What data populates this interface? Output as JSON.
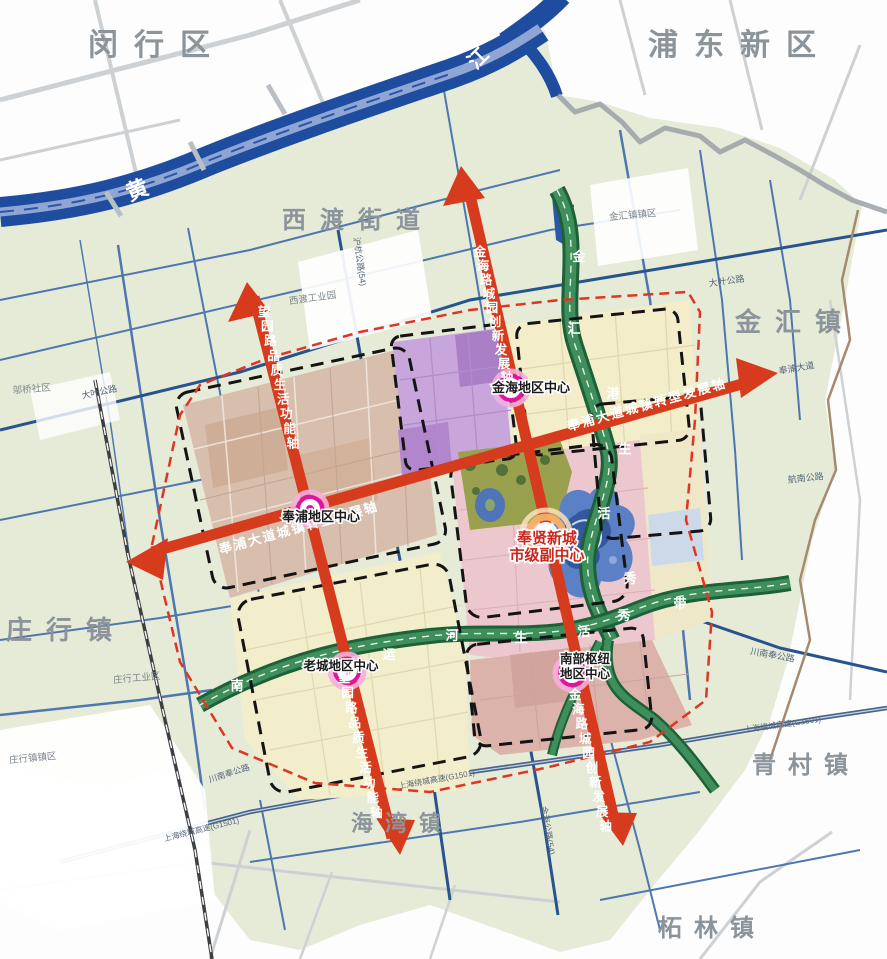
{
  "map_type": "urban-planning-structure-map",
  "core_label": "奉贤新城市级副中心",
  "labels": {
    "districts": [
      {
        "t": "闵行区",
        "x": 157,
        "y": 55,
        "s": 30,
        "ls": 16
      },
      {
        "t": "浦东新区",
        "x": 740,
        "y": 55,
        "s": 30,
        "ls": 16
      },
      {
        "t": "金汇镇",
        "x": 795,
        "y": 331,
        "s": 26,
        "ls": 14
      },
      {
        "t": "庄行镇",
        "x": 66,
        "y": 639,
        "s": 26,
        "ls": 14
      },
      {
        "t": "青村镇",
        "x": 806,
        "y": 773,
        "s": 24,
        "ls": 12
      },
      {
        "t": "柘林镇",
        "x": 712,
        "y": 936,
        "s": 24,
        "ls": 12
      },
      {
        "t": "海湾镇",
        "x": 402,
        "y": 831,
        "s": 22,
        "ls": 12
      },
      {
        "t": "西渡街道",
        "x": 358,
        "y": 228,
        "s": 24,
        "ls": 14
      }
    ],
    "settlements": [
      {
        "t": "西渡工业园",
        "x": 313,
        "y": 301,
        "s": 9.5,
        "rot": -8
      },
      {
        "t": "庄行工业区",
        "x": 137,
        "y": 681,
        "s": 9.5,
        "rot": -5
      },
      {
        "t": "庄行镇镇区",
        "x": 33,
        "y": 761,
        "s": 9.5,
        "rot": -5
      },
      {
        "t": "金汇镇镇区",
        "x": 633,
        "y": 218,
        "s": 9.5,
        "rot": -5
      },
      {
        "t": "邬桥社区",
        "x": 32,
        "y": 392,
        "s": 9.5,
        "rot": -5
      }
    ],
    "roads": [
      {
        "t": "大叶公路",
        "x": 100,
        "y": 395,
        "s": 9,
        "rot": -12
      },
      {
        "t": "大叶公路",
        "x": 727,
        "y": 284,
        "s": 9,
        "rot": -8
      },
      {
        "t": "沪杭公路(54)",
        "x": 357,
        "y": 262,
        "s": 8.5,
        "rot": 82
      },
      {
        "t": "奉浦大道",
        "x": 797,
        "y": 371,
        "s": 9,
        "rot": -10
      },
      {
        "t": "航南公路",
        "x": 806,
        "y": 481,
        "s": 9,
        "rot": -6
      },
      {
        "t": "川南奉公路",
        "x": 772,
        "y": 658,
        "s": 9,
        "rot": 10
      },
      {
        "t": "上海绕城高速(G1501)",
        "x": 783,
        "y": 727,
        "s": 8,
        "rot": -8
      },
      {
        "t": "上海绕城高速(G1501)",
        "x": 437,
        "y": 782,
        "s": 8,
        "rot": -10
      },
      {
        "t": "上海绕城高速(G1501)",
        "x": 202,
        "y": 832,
        "s": 8,
        "rot": -14
      },
      {
        "t": "金海公路(54)",
        "x": 545,
        "y": 831,
        "s": 8.5,
        "rot": 80
      },
      {
        "t": "川南奉公路",
        "x": 230,
        "y": 776,
        "s": 8.5,
        "rot": -18
      }
    ],
    "river_chars": [
      {
        "t": "黄",
        "x": 140,
        "y": 197,
        "s": 22,
        "rot": -22
      },
      {
        "t": "浦",
        "x": 306,
        "y": 102,
        "s": 22,
        "rot": -15
      },
      {
        "t": "江",
        "x": 483,
        "y": 63,
        "s": 20,
        "rot": -45
      }
    ],
    "corridor_chars": [
      {
        "t": "金",
        "x": 579,
        "y": 261,
        "s": 13
      },
      {
        "t": "汇",
        "x": 574,
        "y": 333,
        "s": 13
      },
      {
        "t": "港",
        "x": 613,
        "y": 398,
        "s": 13
      },
      {
        "t": "生",
        "x": 625,
        "y": 453,
        "s": 13
      },
      {
        "t": "活",
        "x": 604,
        "y": 518,
        "s": 13
      },
      {
        "t": "秀",
        "x": 630,
        "y": 583,
        "s": 13
      },
      {
        "t": "南",
        "x": 237,
        "y": 690,
        "s": 13
      },
      {
        "t": "运",
        "x": 389,
        "y": 659,
        "s": 13
      },
      {
        "t": "河",
        "x": 452,
        "y": 640,
        "s": 13
      },
      {
        "t": "生",
        "x": 521,
        "y": 642,
        "s": 13
      },
      {
        "t": "活",
        "x": 584,
        "y": 636,
        "s": 13
      },
      {
        "t": "秀",
        "x": 624,
        "y": 620,
        "s": 13
      },
      {
        "t": "带",
        "x": 680,
        "y": 608,
        "s": 13
      }
    ],
    "axis_labels": [
      {
        "t": "奉浦大道城镇转型发展轴",
        "x": 300,
        "y": 532,
        "s": 13,
        "rot": -15.5,
        "ls": 2
      },
      {
        "t": "奉浦大道城镇转型发展轴",
        "x": 648,
        "y": 409,
        "s": 13,
        "rot": -15.5,
        "ls": 2
      },
      {
        "t": "望园路品质生活功能轴",
        "x": 264,
        "y": 316,
        "s": 12.5,
        "dx": 3.2,
        "dy": 14.6
      },
      {
        "t": "望园路品质生活功能轴",
        "x": 344,
        "y": 682,
        "s": 12.5,
        "dx": 3.6,
        "dy": 15
      },
      {
        "t": "金海路城园创新发展轴",
        "x": 480,
        "y": 256,
        "s": 12.5,
        "dx": 3.0,
        "dy": 14
      },
      {
        "t": "金海路城园创新发展轴",
        "x": 575,
        "y": 699,
        "s": 12.5,
        "dx": 3.4,
        "dy": 14.6
      }
    ]
  },
  "centers": [
    {
      "type": "main",
      "lines": [
        "奉贤新城",
        "市级副中心"
      ],
      "lx": 547,
      "ly": 543,
      "lh": 17,
      "s": 15,
      "ring": {
        "x": 546,
        "y": 534
      }
    },
    {
      "type": "area",
      "lines": [
        "金海地区中心"
      ],
      "lx": 531,
      "ly": 392,
      "lh": 14,
      "s": 13,
      "ring": {
        "x": 511,
        "y": 388
      }
    },
    {
      "type": "area",
      "lines": [
        "奉浦地区中心"
      ],
      "lx": 321,
      "ly": 521,
      "lh": 14,
      "s": 13,
      "ring": {
        "x": 310,
        "y": 509
      }
    },
    {
      "type": "area",
      "lines": [
        "老城地区中心"
      ],
      "lx": 341,
      "ly": 670,
      "lh": 14,
      "s": 12.5,
      "ring": {
        "x": 347,
        "y": 671
      }
    },
    {
      "type": "area",
      "lines": [
        "南部枢纽",
        "地区中心"
      ],
      "lx": 585,
      "ly": 663,
      "lh": 15,
      "s": 12.5,
      "ring": {
        "x": 572,
        "y": 673
      }
    }
  ],
  "colors": {
    "land": "#e6ebd7",
    "river": "#1e4da0",
    "river_channel": "#8fa5d4",
    "corridor_green": "#2a7446",
    "axis_red": "#d63b1e",
    "boundary_red_dash": "#e03424",
    "boundary_black_dash": "#141414",
    "node_ring_magenta": "#e013a3",
    "zone_tan": "#d7bead",
    "zone_purple": "#c8a5da",
    "zone_pink_center": "#ecc8ce",
    "zone_pink_south": "#dcb3ab",
    "zone_yellow": "#f2edca",
    "park_olive": "#9aa14e",
    "lake_blue": "#5b80c6",
    "district_text": "#8b949b"
  }
}
